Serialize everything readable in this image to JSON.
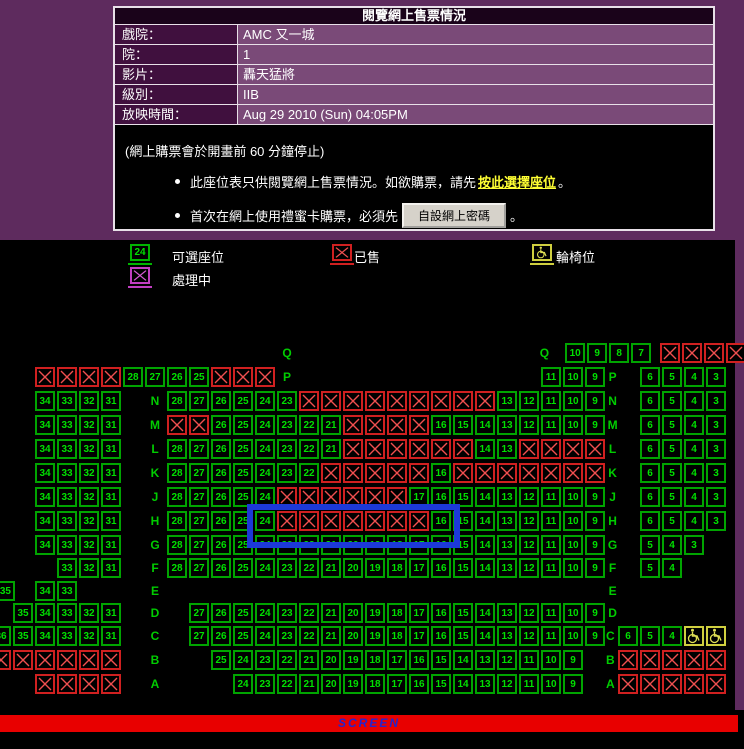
{
  "info_table": {
    "title": "閱覽網上售票情況",
    "rows": [
      {
        "label": "戲院：",
        "value": "AMC 又一城"
      },
      {
        "label": "院：",
        "value": "1"
      },
      {
        "label": "影片：",
        "value": "轟天猛將"
      },
      {
        "label": "級別：",
        "value": "IIB"
      },
      {
        "label": "放映時間：",
        "value": "Aug 29 2010 (Sun) 04:05PM"
      }
    ]
  },
  "notes": {
    "closing_note": "(網上購票會於開畫前 60 分鐘停止)",
    "bullet1_pre": "此座位表只供閱覽網上售票情況。如欲購票，請先",
    "bullet1_link": "按此選擇座位",
    "bullet1_post": "。",
    "bullet2_pre": "首次在網上使用禮蜜卡購票，必須先",
    "bullet2_button": "自設網上密碼",
    "bullet2_post": "。"
  },
  "legend": {
    "available_num": "24",
    "available_label": "可選座位",
    "processing_label": "處理中",
    "sold_label": "已售",
    "wheelchair_label": "輪椅位"
  },
  "screen_label": "SCREEN",
  "colors": {
    "page_bg": "#5e2b5e",
    "panel_bg": "#000000",
    "seat_green": "#00a400",
    "seat_text": "#00e000",
    "sold_red": "#d02020",
    "sold_line": "#f05050",
    "processing_purple": "#c23ec2",
    "wheelchair_yellow": "#cfcf3f",
    "screen_bg": "#e80000",
    "screen_text": "#2424cc",
    "selection_blue": "#1c39d8",
    "link_yellow": "#ffff33"
  },
  "seat_map": {
    "geometry": {
      "origin_x": 35,
      "pitch": 22,
      "box": 20
    },
    "blue_box": {
      "left": 247,
      "top": 504,
      "width": 213,
      "height": 44
    },
    "rows": [
      {
        "row": "Q",
        "y": 343,
        "segs": [
          {
            "c": 11,
            "t": "l",
            "text": "Q"
          },
          {
            "c": 22.7,
            "t": "l",
            "text": "Q"
          },
          {
            "c": 24.1,
            "t": "s",
            "run": [
              10,
              7
            ]
          },
          {
            "c": 28.4,
            "t": "x",
            "count": 4
          }
        ]
      },
      {
        "row": "P",
        "y": 367,
        "segs": [
          {
            "c": 0,
            "t": "x",
            "count": 4
          },
          {
            "c": 4,
            "t": "s",
            "run": [
              28,
              25
            ]
          },
          {
            "c": 8,
            "t": "x",
            "count": 3
          },
          {
            "c": 11,
            "t": "l",
            "text": "P"
          },
          {
            "c": 23,
            "t": "s",
            "run": [
              11,
              9
            ]
          },
          {
            "c": 25.8,
            "t": "l",
            "text": "P"
          },
          {
            "c": 27.5,
            "t": "s",
            "run": [
              6,
              3
            ]
          }
        ]
      },
      {
        "row": "N",
        "y": 391,
        "segs": [
          {
            "c": 0,
            "t": "s",
            "run": [
              34,
              31
            ]
          },
          {
            "c": 5,
            "t": "l",
            "text": "N"
          },
          {
            "c": 6,
            "t": "s",
            "run": [
              28,
              23
            ]
          },
          {
            "c": 12,
            "t": "x",
            "count": 9
          },
          {
            "c": 21,
            "t": "s",
            "run": [
              13,
              9
            ]
          },
          {
            "c": 25.8,
            "t": "l",
            "text": "N"
          },
          {
            "c": 27.5,
            "t": "s",
            "run": [
              6,
              3
            ]
          }
        ]
      },
      {
        "row": "M",
        "y": 415,
        "segs": [
          {
            "c": 0,
            "t": "s",
            "run": [
              34,
              31
            ]
          },
          {
            "c": 5,
            "t": "l",
            "text": "M"
          },
          {
            "c": 6,
            "t": "x",
            "count": 2
          },
          {
            "c": 8,
            "t": "s",
            "run": [
              26,
              21
            ]
          },
          {
            "c": 14,
            "t": "x",
            "count": 4
          },
          {
            "c": 18,
            "t": "s",
            "run": [
              16,
              14
            ]
          },
          {
            "c": 21,
            "t": "s",
            "run": [
              13,
              9
            ]
          },
          {
            "c": 25.8,
            "t": "l",
            "text": "M"
          },
          {
            "c": 27.5,
            "t": "s",
            "run": [
              6,
              3
            ]
          }
        ]
      },
      {
        "row": "L",
        "y": 439,
        "segs": [
          {
            "c": 0,
            "t": "s",
            "run": [
              34,
              31
            ]
          },
          {
            "c": 5,
            "t": "l",
            "text": "L"
          },
          {
            "c": 6,
            "t": "s",
            "run": [
              28,
              21
            ]
          },
          {
            "c": 14,
            "t": "x",
            "count": 6
          },
          {
            "c": 20,
            "t": "s",
            "run": [
              14,
              13
            ]
          },
          {
            "c": 22,
            "t": "x",
            "count": 4
          },
          {
            "c": 25.8,
            "t": "l",
            "text": "L"
          },
          {
            "c": 27.5,
            "t": "s",
            "run": [
              6,
              3
            ]
          }
        ]
      },
      {
        "row": "K",
        "y": 463,
        "segs": [
          {
            "c": 0,
            "t": "s",
            "run": [
              34,
              31
            ]
          },
          {
            "c": 5,
            "t": "l",
            "text": "K"
          },
          {
            "c": 6,
            "t": "s",
            "run": [
              28,
              22
            ]
          },
          {
            "c": 13,
            "t": "x",
            "count": 5
          },
          {
            "c": 18,
            "t": "s",
            "run": [
              16,
              16
            ]
          },
          {
            "c": 19,
            "t": "x",
            "count": 7
          },
          {
            "c": 25.8,
            "t": "l",
            "text": "K"
          },
          {
            "c": 27.5,
            "t": "s",
            "run": [
              6,
              3
            ]
          }
        ]
      },
      {
        "row": "J",
        "y": 487,
        "segs": [
          {
            "c": 0,
            "t": "s",
            "run": [
              34,
              31
            ]
          },
          {
            "c": 5,
            "t": "l",
            "text": "J"
          },
          {
            "c": 6,
            "t": "s",
            "run": [
              28,
              24
            ]
          },
          {
            "c": 11,
            "t": "x",
            "count": 6
          },
          {
            "c": 17,
            "t": "s",
            "run": [
              17,
              14
            ]
          },
          {
            "c": 21,
            "t": "s",
            "run": [
              13,
              9
            ]
          },
          {
            "c": 25.8,
            "t": "l",
            "text": "J"
          },
          {
            "c": 27.5,
            "t": "s",
            "run": [
              6,
              3
            ]
          }
        ]
      },
      {
        "row": "H",
        "y": 511,
        "segs": [
          {
            "c": 0,
            "t": "s",
            "run": [
              34,
              31
            ]
          },
          {
            "c": 5,
            "t": "l",
            "text": "H"
          },
          {
            "c": 6,
            "t": "s",
            "run": [
              28,
              25
            ]
          },
          {
            "c": 10,
            "t": "s",
            "run": [
              24,
              24
            ]
          },
          {
            "c": 11,
            "t": "x",
            "count": 7
          },
          {
            "c": 18,
            "t": "s",
            "run": [
              16,
              14
            ]
          },
          {
            "c": 21,
            "t": "s",
            "run": [
              13,
              9
            ]
          },
          {
            "c": 25.8,
            "t": "l",
            "text": "H"
          },
          {
            "c": 27.5,
            "t": "s",
            "run": [
              6,
              3
            ]
          }
        ]
      },
      {
        "row": "G",
        "y": 535,
        "segs": [
          {
            "c": 0,
            "t": "s",
            "run": [
              34,
              31
            ]
          },
          {
            "c": 5,
            "t": "l",
            "text": "G"
          },
          {
            "c": 6,
            "t": "s",
            "run": [
              28,
              9
            ]
          },
          {
            "c": 25.8,
            "t": "l",
            "text": "G"
          },
          {
            "c": 27.5,
            "t": "s",
            "run": [
              5,
              3
            ]
          }
        ]
      },
      {
        "row": "F",
        "y": 558,
        "segs": [
          {
            "c": 1,
            "t": "s",
            "run": [
              33,
              31
            ]
          },
          {
            "c": 5,
            "t": "l",
            "text": "F"
          },
          {
            "c": 6,
            "t": "s",
            "run": [
              28,
              9
            ]
          },
          {
            "c": 25.8,
            "t": "l",
            "text": "F"
          },
          {
            "c": 27.5,
            "t": "s",
            "run": [
              5,
              4
            ]
          }
        ]
      },
      {
        "row": "E",
        "y": 581,
        "segs": [
          {
            "c": -1.8,
            "t": "s",
            "run": [
              35,
              35
            ]
          },
          {
            "c": 0,
            "t": "s",
            "run": [
              34,
              33
            ]
          },
          {
            "c": 5,
            "t": "l",
            "text": "E"
          },
          {
            "c": 25.8,
            "t": "l",
            "text": "E"
          }
        ]
      },
      {
        "row": "D",
        "y": 603,
        "segs": [
          {
            "c": -1,
            "t": "s",
            "run": [
              35,
              31
            ]
          },
          {
            "c": 5,
            "t": "l",
            "text": "D"
          },
          {
            "c": 7,
            "t": "s",
            "run": [
              27,
              9
            ]
          },
          {
            "c": 25.8,
            "t": "l",
            "text": "D"
          }
        ]
      },
      {
        "row": "C",
        "y": 626,
        "segs": [
          {
            "c": -2,
            "t": "s",
            "run": [
              36,
              31
            ]
          },
          {
            "c": 5,
            "t": "l",
            "text": "C"
          },
          {
            "c": 7,
            "t": "s",
            "run": [
              27,
              9
            ]
          },
          {
            "c": 25.7,
            "t": "l",
            "text": "C"
          },
          {
            "c": 26.5,
            "t": "s",
            "run": [
              6,
              4
            ]
          },
          {
            "c": 29.5,
            "t": "w",
            "count": 2
          }
        ]
      },
      {
        "row": "B",
        "y": 650,
        "segs": [
          {
            "c": -2,
            "t": "x",
            "count": 6
          },
          {
            "c": 5,
            "t": "l",
            "text": "B"
          },
          {
            "c": 8,
            "t": "s",
            "run": [
              25,
              9
            ]
          },
          {
            "c": 25.7,
            "t": "l",
            "text": "B"
          },
          {
            "c": 26.5,
            "t": "x",
            "count": 5
          }
        ]
      },
      {
        "row": "A",
        "y": 674,
        "segs": [
          {
            "c": 0,
            "t": "x",
            "count": 4
          },
          {
            "c": 5,
            "t": "l",
            "text": "A"
          },
          {
            "c": 9,
            "t": "s",
            "run": [
              24,
              9
            ]
          },
          {
            "c": 25.7,
            "t": "l",
            "text": "A"
          },
          {
            "c": 26.5,
            "t": "x",
            "count": 5
          }
        ]
      }
    ]
  }
}
